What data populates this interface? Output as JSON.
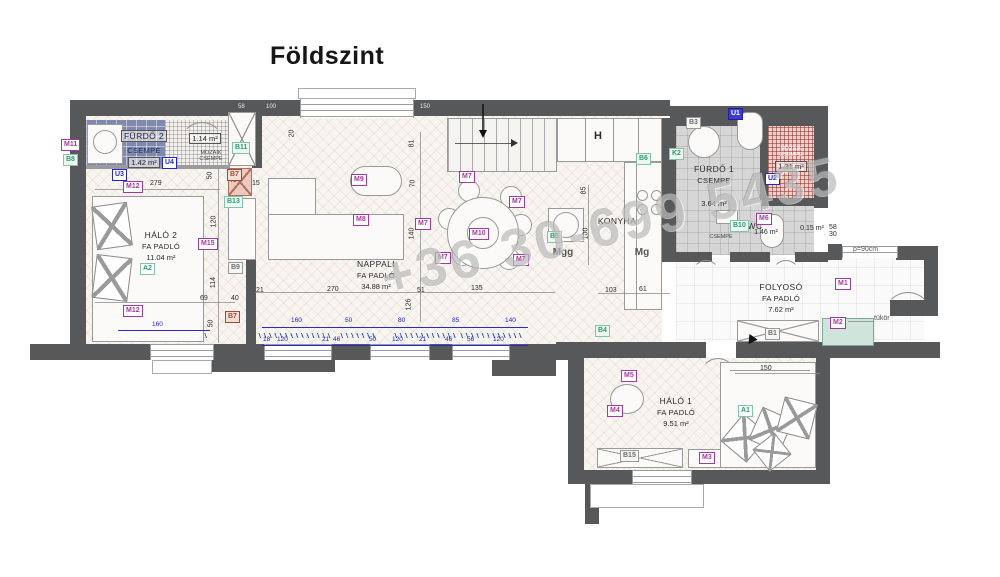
{
  "title": "Földszint",
  "watermark": "+36 30-699 5435",
  "colors": {
    "wall": "#57585a",
    "tile_blue": "#7f88ad",
    "mosaic_red": "#b05040",
    "dim_blue": "#2222cc",
    "marker_purple": "#a23a9b",
    "marker_green": "#2f9a72",
    "marker_blue": "#2626c4"
  },
  "rooms": {
    "furdo2": {
      "name": "FÜRDŐ 2",
      "finish": "CSEMPE",
      "area": "1.42 m²",
      "mosaic_area": "1.14 m²",
      "mosaic_finish": "MOZAIK CSEMPE"
    },
    "halo2": {
      "name": "HÁLÓ 2",
      "finish": "FA PADLÓ",
      "area": "11.04 m²"
    },
    "nappali": {
      "name": "NAPPALI",
      "finish": "FA PADLÓ",
      "area": "34.88 m²"
    },
    "konyha": {
      "name": "KONYHA",
      "hood": "H",
      "dishwasher": "Mgg",
      "fridge": "Mg"
    },
    "furdo1": {
      "name": "FÜRDŐ 1",
      "finish": "CSEMPE",
      "area": "3.64 m²",
      "mosaic_finish": "MOZAIK CSEMPE",
      "mosaic_area": "1.31 m²"
    },
    "wc": {
      "name": "WC",
      "area": "1.46 m²",
      "finish": "CSEMPE",
      "niche": "0.15 m²",
      "stack_top": "58",
      "stack_bottom": "30"
    },
    "folyoso": {
      "name": "FOLYOSÓ",
      "finish": "FA PADLÓ",
      "area": "7.62 m²",
      "mirror": "tükör",
      "window": "p=90cm"
    },
    "halo1": {
      "name": "HÁLÓ 1",
      "finish": "FA PADLÓ",
      "area": "9.51 m²"
    }
  },
  "markers": [
    {
      "id": "M11",
      "cls": "m",
      "x": 61,
      "y": 139
    },
    {
      "id": "B8",
      "cls": "g",
      "x": 63,
      "y": 154
    },
    {
      "id": "U4",
      "cls": "u",
      "x": 162,
      "y": 157
    },
    {
      "id": "U3",
      "cls": "u",
      "x": 112,
      "y": 169
    },
    {
      "id": "M12",
      "cls": "m",
      "x": 123,
      "y": 181
    },
    {
      "id": "M12",
      "cls": "m",
      "x": 123,
      "y": 305
    },
    {
      "id": "B11",
      "cls": "g",
      "x": 232,
      "y": 142
    },
    {
      "id": "B7",
      "cls": "r",
      "x": 227,
      "y": 169
    },
    {
      "id": "B13",
      "cls": "g",
      "x": 224,
      "y": 196
    },
    {
      "id": "M15",
      "cls": "m",
      "x": 198,
      "y": 238
    },
    {
      "id": "B9",
      "cls": "gr",
      "x": 228,
      "y": 262
    },
    {
      "id": "B7",
      "cls": "r",
      "x": 225,
      "y": 311
    },
    {
      "id": "A2",
      "cls": "a",
      "x": 140,
      "y": 263
    },
    {
      "id": "M9",
      "cls": "m",
      "x": 351,
      "y": 174
    },
    {
      "id": "M8",
      "cls": "m",
      "x": 353,
      "y": 214
    },
    {
      "id": "M7",
      "cls": "m",
      "x": 459,
      "y": 171
    },
    {
      "id": "M7",
      "cls": "m",
      "x": 415,
      "y": 218
    },
    {
      "id": "M7",
      "cls": "m",
      "x": 435,
      "y": 252
    },
    {
      "id": "M7",
      "cls": "m",
      "x": 509,
      "y": 196
    },
    {
      "id": "M7",
      "cls": "m",
      "x": 513,
      "y": 254
    },
    {
      "id": "M10",
      "cls": "m",
      "x": 469,
      "y": 228
    },
    {
      "id": "B6",
      "cls": "g",
      "x": 636,
      "y": 153
    },
    {
      "id": "B5",
      "cls": "g",
      "x": 547,
      "y": 231
    },
    {
      "id": "B4",
      "cls": "g",
      "x": 595,
      "y": 325
    },
    {
      "id": "B3",
      "cls": "gr",
      "x": 686,
      "y": 117
    },
    {
      "id": "U1",
      "cls": "u1",
      "x": 728,
      "y": 108
    },
    {
      "id": "K2",
      "cls": "g",
      "x": 669,
      "y": 148
    },
    {
      "id": "U2",
      "cls": "u",
      "x": 765,
      "y": 173
    },
    {
      "id": "M6",
      "cls": "m",
      "x": 756,
      "y": 213
    },
    {
      "id": "B10",
      "cls": "g",
      "x": 730,
      "y": 220
    },
    {
      "id": "M1",
      "cls": "m",
      "x": 835,
      "y": 278
    },
    {
      "id": "M2",
      "cls": "m",
      "x": 830,
      "y": 317
    },
    {
      "id": "B1",
      "cls": "gr",
      "x": 765,
      "y": 328
    },
    {
      "id": "M5",
      "cls": "m",
      "x": 621,
      "y": 370
    },
    {
      "id": "M4",
      "cls": "m",
      "x": 607,
      "y": 405
    },
    {
      "id": "B15",
      "cls": "gr",
      "x": 620,
      "y": 450
    },
    {
      "id": "M3",
      "cls": "m",
      "x": 699,
      "y": 452
    },
    {
      "id": "A1",
      "cls": "a",
      "x": 738,
      "y": 405
    }
  ],
  "dims_black": [
    {
      "t": "279",
      "x": 150,
      "y": 180
    },
    {
      "t": "50",
      "x": 206,
      "y": 172,
      "v": 1
    },
    {
      "t": "40",
      "x": 229,
      "y": 177
    },
    {
      "t": "15",
      "x": 252,
      "y": 180
    },
    {
      "t": "20",
      "x": 288,
      "y": 130,
      "v": 1
    },
    {
      "t": "81",
      "x": 408,
      "y": 140,
      "v": 1
    },
    {
      "t": "70",
      "x": 409,
      "y": 180,
      "v": 1
    },
    {
      "t": "140",
      "x": 406,
      "y": 230,
      "v": 1
    },
    {
      "t": "120",
      "x": 208,
      "y": 218,
      "v": 1
    },
    {
      "t": "114",
      "x": 208,
      "y": 279,
      "v": 1
    },
    {
      "t": "69",
      "x": 200,
      "y": 295
    },
    {
      "t": "40",
      "x": 231,
      "y": 295
    },
    {
      "t": "50",
      "x": 207,
      "y": 320,
      "v": 1
    },
    {
      "t": "21",
      "x": 256,
      "y": 287
    },
    {
      "t": "270",
      "x": 327,
      "y": 286
    },
    {
      "t": "51",
      "x": 417,
      "y": 287
    },
    {
      "t": "126",
      "x": 403,
      "y": 301,
      "v": 1
    },
    {
      "t": "135",
      "x": 471,
      "y": 285
    },
    {
      "t": "85",
      "x": 580,
      "y": 187,
      "v": 1
    },
    {
      "t": "100",
      "x": 580,
      "y": 230,
      "v": 1
    },
    {
      "t": "103",
      "x": 605,
      "y": 287
    },
    {
      "t": "61",
      "x": 639,
      "y": 286
    },
    {
      "t": "150",
      "x": 760,
      "y": 365
    }
  ],
  "dims_blue": [
    {
      "t": "160",
      "x": 152,
      "y": 321
    },
    {
      "t": "160",
      "x": 291,
      "y": 317
    },
    {
      "t": "50",
      "x": 345,
      "y": 317
    },
    {
      "t": "80",
      "x": 398,
      "y": 317
    },
    {
      "t": "85",
      "x": 452,
      "y": 317
    },
    {
      "t": "140",
      "x": 505,
      "y": 317
    },
    {
      "t": "18",
      "x": 263,
      "y": 336
    },
    {
      "t": "120",
      "x": 277,
      "y": 336
    },
    {
      "t": "21",
      "x": 322,
      "y": 336
    },
    {
      "t": "46",
      "x": 333,
      "y": 336
    },
    {
      "t": "50",
      "x": 369,
      "y": 336
    },
    {
      "t": "120",
      "x": 392,
      "y": 336
    },
    {
      "t": "21",
      "x": 419,
      "y": 336
    },
    {
      "t": "46",
      "x": 445,
      "y": 336
    },
    {
      "t": "56",
      "x": 467,
      "y": 336
    },
    {
      "t": "120",
      "x": 493,
      "y": 336
    }
  ],
  "wall_texts": [
    {
      "t": "58",
      "x": 238,
      "y": 104
    },
    {
      "t": "100",
      "x": 266,
      "y": 104
    },
    {
      "t": "400",
      "x": 348,
      "y": 104
    },
    {
      "t": "150",
      "x": 420,
      "y": 104
    }
  ]
}
